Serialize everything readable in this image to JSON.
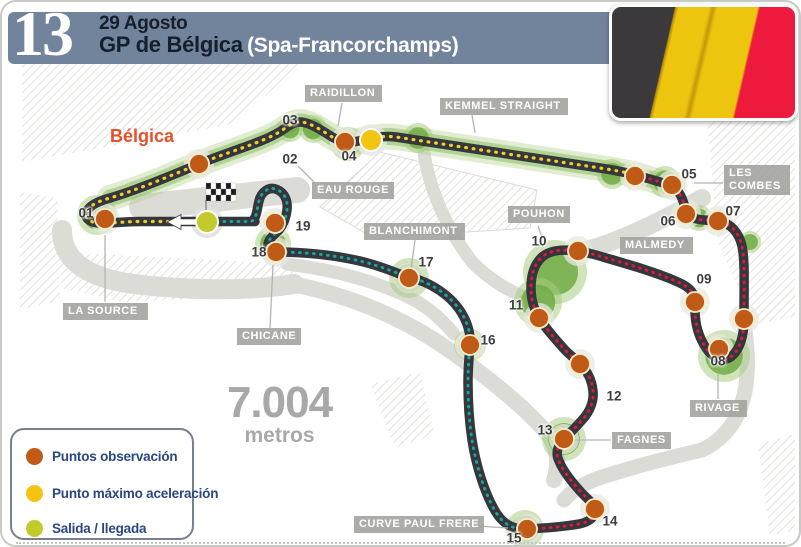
{
  "header": {
    "round_number": "13",
    "date": "29 Agosto",
    "title": "GP de Bélgica",
    "subtitle": "(Spa-Francorchamps)"
  },
  "country_label": "Bélgica",
  "track_length": {
    "value": "7.004",
    "unit": "metros"
  },
  "legend": {
    "items": [
      {
        "label": "Puntos observación",
        "color": "#bf5b17"
      },
      {
        "label": "Punto máximo aceleración",
        "color": "#f3c412"
      },
      {
        "label": "Salida / llegada",
        "color": "#c3ca2b"
      }
    ]
  },
  "colors": {
    "track": "#34373b",
    "sector_flatout": "#f0cd2a",
    "sector_braking": "#e2173d",
    "sector_final": "#17a39e",
    "observation_dot": "#bf5b17",
    "max_accel_dot": "#f3c412",
    "start_dot": "#c3ca2b",
    "vegetation": "#71ab45",
    "header_bar": "#72839c",
    "flag_stripes": [
      "#3b393c",
      "#eec50e",
      "#ee1a3e"
    ]
  },
  "corner_labels": [
    {
      "id": "raidillon",
      "text": "RAIDILLON",
      "x": 303,
      "y": 83,
      "w": 77
    },
    {
      "id": "kemmel-straight",
      "text": "KEMMEL STRAIGHT",
      "x": 438,
      "y": 96,
      "w": 128
    },
    {
      "id": "eau-rouge",
      "text": "EAU ROUGE",
      "x": 310,
      "y": 180,
      "w": 78
    },
    {
      "id": "les-combes",
      "text": "LES\nCOMBES",
      "x": 722,
      "y": 163,
      "w": 66
    },
    {
      "id": "malmedy",
      "text": "MALMEDY",
      "x": 618,
      "y": 235,
      "w": 73
    },
    {
      "id": "pouhon",
      "text": "POUHON",
      "x": 506,
      "y": 204,
      "w": 58
    },
    {
      "id": "blanchimont",
      "text": "BLANCHIMONT",
      "x": 362,
      "y": 221,
      "w": 101
    },
    {
      "id": "la-source",
      "text": "LA SOURCE",
      "x": 61,
      "y": 301,
      "w": 85
    },
    {
      "id": "chicane",
      "text": "CHICANE",
      "x": 235,
      "y": 326,
      "w": 64
    },
    {
      "id": "rivage",
      "text": "RIVAGE",
      "x": 688,
      "y": 398,
      "w": 57
    },
    {
      "id": "fagnes",
      "text": "FAGNES",
      "x": 610,
      "y": 430,
      "w": 54
    },
    {
      "id": "curve-paul-frere",
      "text": "CURVE PAUL FRERE",
      "x": 352,
      "y": 514,
      "w": 122
    }
  ],
  "leader_lines": [
    [
      340,
      101,
      336,
      124
    ],
    [
      470,
      113,
      473,
      131
    ],
    [
      312,
      180,
      296,
      164
    ],
    [
      721,
      181,
      692,
      181
    ],
    [
      536,
      224,
      542,
      241
    ],
    [
      413,
      238,
      409,
      267
    ],
    [
      103,
      300,
      103,
      233
    ],
    [
      268,
      326,
      271,
      263
    ],
    [
      716,
      397,
      716,
      372
    ],
    [
      609,
      438,
      573,
      438
    ],
    [
      475,
      524,
      506,
      526
    ]
  ],
  "number_labels": [
    {
      "n": "01",
      "x": 84,
      "y": 211
    },
    {
      "n": "02",
      "x": 288,
      "y": 157
    },
    {
      "n": "03",
      "x": 288,
      "y": 118
    },
    {
      "n": "04",
      "x": 347,
      "y": 154
    },
    {
      "n": "05",
      "x": 687,
      "y": 172
    },
    {
      "n": "06",
      "x": 666,
      "y": 219
    },
    {
      "n": "07",
      "x": 731,
      "y": 209
    },
    {
      "n": "08",
      "x": 716,
      "y": 359
    },
    {
      "n": "09",
      "x": 702,
      "y": 277
    },
    {
      "n": "10",
      "x": 537,
      "y": 239
    },
    {
      "n": "11",
      "x": 514,
      "y": 303
    },
    {
      "n": "12",
      "x": 612,
      "y": 394
    },
    {
      "n": "13",
      "x": 543,
      "y": 428
    },
    {
      "n": "14",
      "x": 608,
      "y": 519
    },
    {
      "n": "15",
      "x": 512,
      "y": 536
    },
    {
      "n": "16",
      "x": 486,
      "y": 338
    },
    {
      "n": "17",
      "x": 424,
      "y": 260
    },
    {
      "n": "18",
      "x": 257,
      "y": 250
    },
    {
      "n": "19",
      "x": 301,
      "y": 224
    }
  ],
  "observation_dots": [
    [
      103,
      217
    ],
    [
      197,
      162
    ],
    [
      343,
      140
    ],
    [
      633,
      174
    ],
    [
      670,
      183
    ],
    [
      684,
      212
    ],
    [
      716,
      219
    ],
    [
      742,
      317
    ],
    [
      717,
      347
    ],
    [
      693,
      300
    ],
    [
      576,
      249
    ],
    [
      537,
      316
    ],
    [
      578,
      362
    ],
    [
      562,
      437
    ],
    [
      593,
      507
    ],
    [
      525,
      527
    ],
    [
      468,
      343
    ],
    [
      407,
      276
    ],
    [
      274,
      250
    ],
    [
      273,
      221
    ]
  ],
  "max_accel_dot": [
    369,
    138
  ],
  "start_finish_dot": [
    205,
    220
  ]
}
